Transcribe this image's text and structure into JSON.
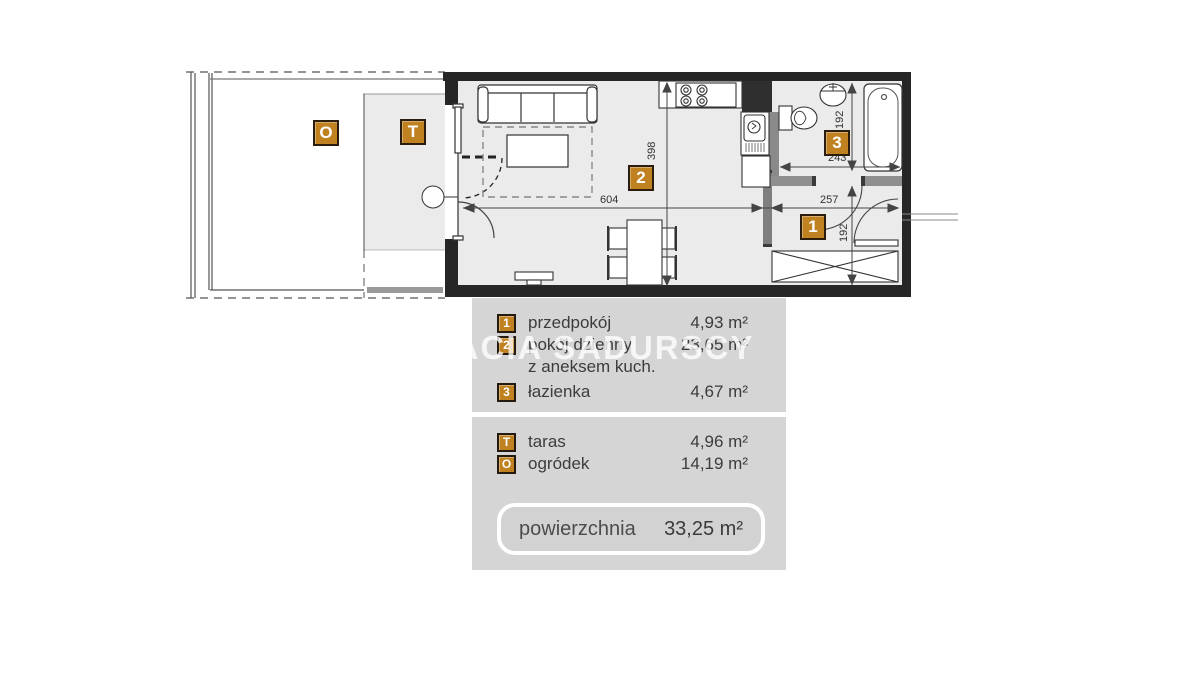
{
  "watermark": "BRACIA SADURSCY",
  "plan": {
    "room_badges": {
      "garden": "O",
      "terrace": "T",
      "hall": "1",
      "living": "2",
      "bath": "3"
    },
    "dimensions": {
      "living_height": "398",
      "living_width": "604",
      "hall_width": "257",
      "hall_height": "192",
      "bath_width": "243",
      "bath_height": "192"
    }
  },
  "legend": {
    "rooms": [
      {
        "badge": "1",
        "label": "przedpokój",
        "area": "4,93 m²"
      },
      {
        "badge": "2",
        "label": "pokój dzienny",
        "label2": "z aneksem kuch.",
        "area": "23,65 m²"
      },
      {
        "badge": "3",
        "label": "łazienka",
        "area": "4,67 m²"
      }
    ],
    "outdoor": [
      {
        "badge": "T",
        "label": "taras",
        "area": "4,96 m²"
      },
      {
        "badge": "O",
        "label": "ogródek",
        "area": "14,19 m²"
      }
    ],
    "total": {
      "label": "powierzchnia",
      "area": "33,25 m²"
    }
  },
  "colors": {
    "badge_orange": "#c08120",
    "wall_black": "#262626",
    "partition_gray": "#7f7f7f",
    "floor_gray": "#ebebeb",
    "panel_gray": "#d5d5d5"
  }
}
